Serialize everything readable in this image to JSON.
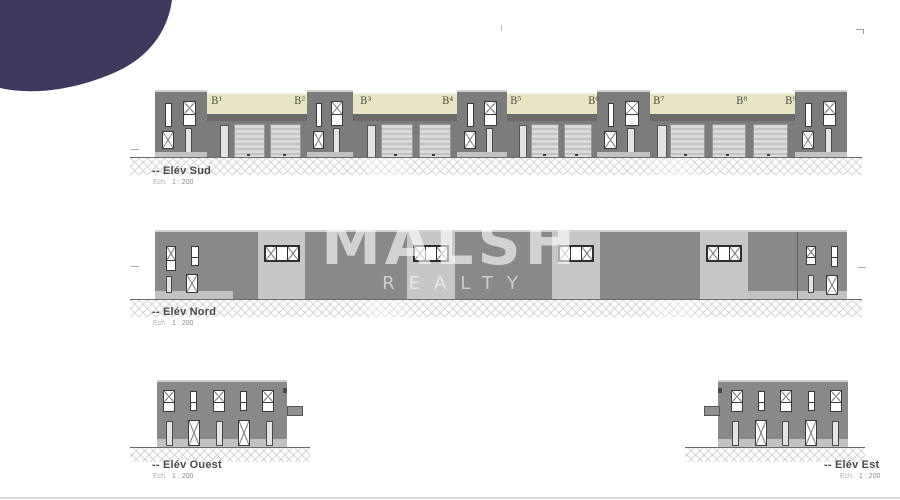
{
  "watermark": {
    "line1": "MALSH",
    "line2": "REALTY"
  },
  "elevations": {
    "sud": {
      "label": "-- Elév Sud",
      "scale_prefix": "Ech.",
      "scale_value": "1 : 200",
      "unit_labels": [
        "B¹",
        "B²",
        "B³",
        "B⁴",
        "B⁵",
        "B⁶",
        "B⁷",
        "B⁸",
        "B⁹"
      ]
    },
    "nord": {
      "label": "-- Elév Nord",
      "scale_prefix": "Ech.",
      "scale_value": "1 : 200"
    },
    "ouest": {
      "label": "-- Elév Ouest",
      "scale_prefix": "Ech.",
      "scale_value": "1 : 200"
    },
    "est": {
      "label": "-- Elév Est",
      "scale_prefix": "Ech.",
      "scale_value": "1 : 200"
    }
  },
  "colors": {
    "brand_blob": "#3f3a5d",
    "wall_dark": "#7c7c7c",
    "wall_mid": "#898989",
    "panel_light": "#c7c7c7",
    "facade_cream": "#e8e4c6",
    "lintel": "#6a6a6a",
    "garage_door": "#d4d4d4",
    "base_strip": "#c2c2c2",
    "label_text": "#4a4a4a",
    "watermark": "rgba(255,255,255,0.6)"
  }
}
